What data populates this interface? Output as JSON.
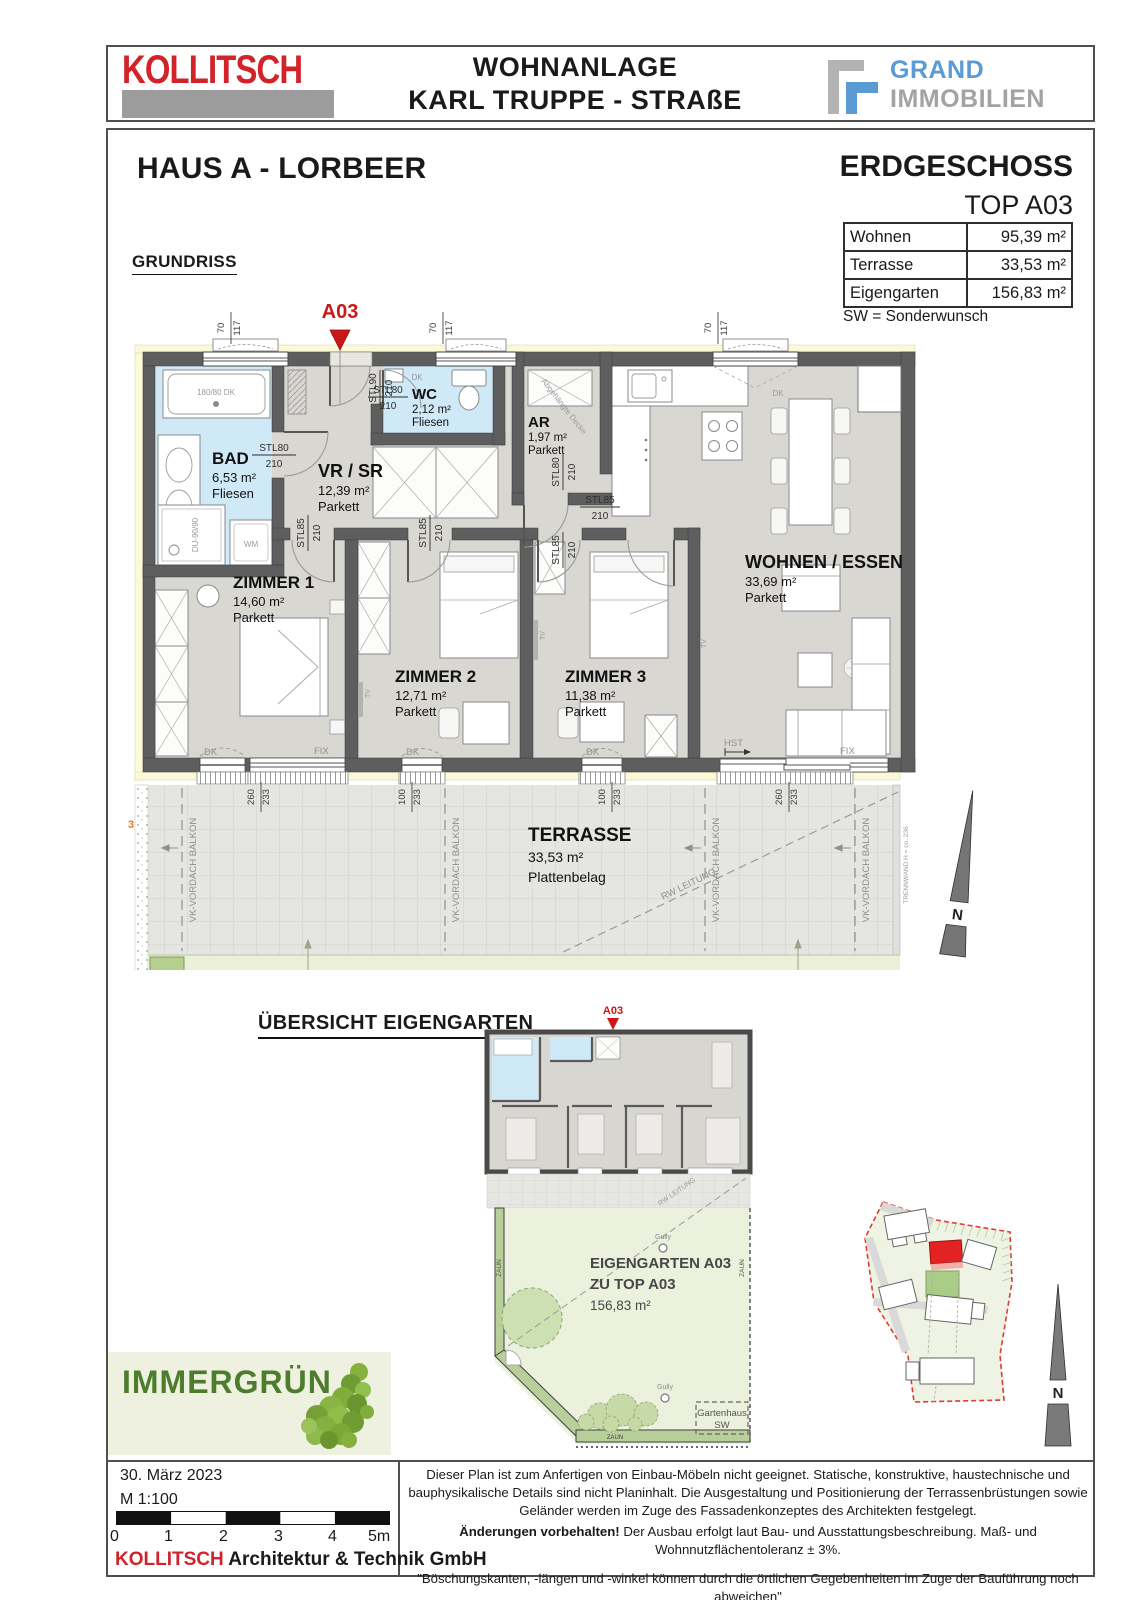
{
  "colors": {
    "brand_red": "#d2232a",
    "marker_red": "#cc1719",
    "grand_blue": "#5b9bd5",
    "grand_gray": "#a3a3a3",
    "immergruen_green": "#4d7d2c"
  },
  "header": {
    "brand": "KOLLITSCH",
    "title_line1": "WOHNANLAGE",
    "title_line2": "KARL TRUPPE - STRAßE",
    "grand_top": "GRAND",
    "grand_bottom": "IMMOBILIEN"
  },
  "info": {
    "house": "HAUS A - LORBEER",
    "floor": "ERDGESCHOSS",
    "unit": "TOP A03",
    "areas": [
      {
        "label": "Wohnen",
        "value": "95,39 m²"
      },
      {
        "label": "Terrasse",
        "value": "33,53 m²"
      },
      {
        "label": "Eigengarten",
        "value": "156,83 m²"
      }
    ],
    "note": "SW = Sonderwunsch"
  },
  "plan": {
    "title": "GRUNDRISS",
    "marker": "A03",
    "rooms": [
      {
        "name": "BAD",
        "area": "6,53 m²",
        "floor": "Fliesen"
      },
      {
        "name": "WC",
        "area": "2,12 m²",
        "floor": "Fliesen"
      },
      {
        "name": "VR / SR",
        "area": "12,39 m²",
        "floor": "Parkett"
      },
      {
        "name": "AR",
        "area": "1,97 m²",
        "floor": "Parkett"
      },
      {
        "name": "ZIMMER 1",
        "area": "14,60 m²",
        "floor": "Parkett"
      },
      {
        "name": "ZIMMER 2",
        "area": "12,71 m²",
        "floor": "Parkett"
      },
      {
        "name": "ZIMMER 3",
        "area": "11,38 m²",
        "floor": "Parkett"
      },
      {
        "name": "WOHNEN / ESSEN",
        "area": "33,69 m²",
        "floor": "Parkett"
      },
      {
        "name": "TERRASSE",
        "area": "33,53 m²",
        "floor": "Plattenbelag"
      }
    ],
    "labels": {
      "stl90": "STL90",
      "stl80": "STL80",
      "stl85": "STL85",
      "h": "210",
      "w70": "70",
      "w117": "117",
      "d260": "260",
      "d233": "233",
      "d100": "100",
      "dk": "DK",
      "fix": "FIX",
      "hst": "HST",
      "tv": "TV",
      "wm": "WM",
      "tub": "180/80 DK",
      "shower": "DU-90/90",
      "ceiling": "Abgehängte Decke",
      "vk": "VK-VORDACH BALKON",
      "rw": "RW LEITUNG",
      "trennwand": "TRENNWAND H = co. 236",
      "side": "3",
      "north": "N"
    }
  },
  "garden": {
    "heading": "ÜBERSICHT EIGENGARTEN",
    "marker": "A03",
    "line1": "EIGENGARTEN A03",
    "line2": "ZU TOP A03",
    "area": "156,83 m²",
    "gully": "Gully",
    "zaun": "ZAUN",
    "gartenhaus_line1": "Gartenhaus",
    "gartenhaus_line2": "SW"
  },
  "immergruen": {
    "label": "IMMERGRÜN"
  },
  "footer": {
    "date": "30. März 2023",
    "scale": "M 1:100",
    "ticks": [
      "0",
      "1",
      "2",
      "3",
      "4",
      "5m"
    ],
    "company_brand": "KOLLITSCH",
    "company_rest": " Architektur & Technik GmbH",
    "disclaimer1": "Dieser Plan ist zum Anfertigen von Einbau-Möbeln nicht geeignet. Statische, konstruktive, haustechnische und bauphysikalische Details sind nicht Planinhalt. Die Ausgestaltung und Positionierung der Terrassenbrüstungen sowie Geländer werden im Zuge des Fassadenkonzeptes des Architekten festgelegt.",
    "disclaimer2_bold": "Änderungen vorbehalten!",
    "disclaimer2_rest": " Der Ausbau erfolgt laut Bau- und Ausstattungsbeschreibung. Maß- und Wohnnutzflächentoleranz ± 3%.",
    "disclaimer3": "\"Böschungskanten, -längen und -winkel können durch die örtlichen Gegebenheiten im Zuge der Bauführung noch abweichen\""
  }
}
